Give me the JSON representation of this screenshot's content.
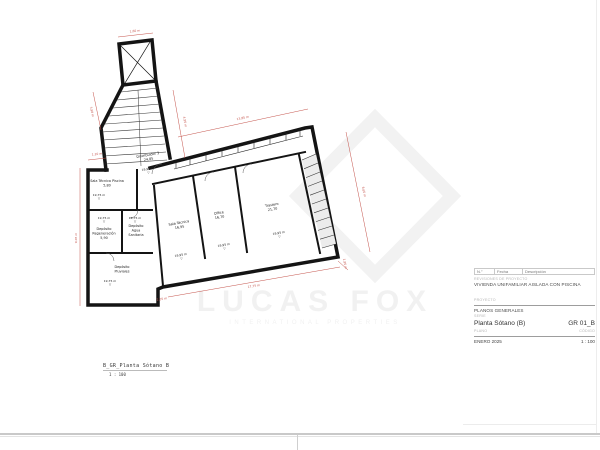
{
  "sheet": {
    "watermark": {
      "brand": "LUCAS FOX",
      "tagline": "INTERNATIONAL PROPERTIES"
    },
    "caption": {
      "title": "B_GR_Planta Sótano B",
      "scale": "1 : 100"
    },
    "titleblock": {
      "rev_col_no": "N.°",
      "rev_col_date": "Fecha",
      "rev_col_desc": "Descripción",
      "revisions_label": "REVISIONES DE PROYECTO",
      "project_name": "VIVIENDA UNIFAMILIAR AISLADA CON PISCINA",
      "project_label": "PROYECTO",
      "series_name": "PLANOS GENERALES",
      "series_label": "SERIE",
      "plan_name": "Planta Sótano (B)",
      "plan_code": "GR 01_B",
      "plan_label": "PLANO",
      "code_label": "CÓDIGO",
      "date": "ENERO 2025",
      "scale": "1 : 100"
    },
    "plan": {
      "rooms": [
        {
          "lines": [
            "Distribuidor 3",
            "24,85"
          ],
          "x": 148,
          "y": 156,
          "rot": -10
        },
        {
          "lines": [
            "Sala Técnica Piscina",
            "5,80"
          ],
          "x": 107,
          "y": 182,
          "rot": 0
        },
        {
          "lines": [
            "Depósito",
            "Regeneración",
            "5,90"
          ],
          "x": 104,
          "y": 230,
          "rot": 0
        },
        {
          "lines": [
            "Depósito",
            "Agua",
            "Sanitaria"
          ],
          "x": 136,
          "y": 227,
          "rot": 0
        },
        {
          "lines": [
            "Depósito",
            "Pluviales"
          ],
          "x": 122,
          "y": 268,
          "rot": 0
        },
        {
          "lines": [
            "Sala Técnica",
            "16,95"
          ],
          "x": 179,
          "y": 224,
          "rot": -10
        },
        {
          "lines": [
            "Office",
            "16,70"
          ],
          "x": 219,
          "y": 214,
          "rot": -10
        },
        {
          "lines": [
            "Trastero",
            "21,70"
          ],
          "x": 272,
          "y": 206,
          "rot": -10
        }
      ],
      "elevations": [
        {
          "value": "19,95 m",
          "x": 148,
          "y": 170,
          "rot": -10
        },
        {
          "value": "19,75 m",
          "x": 99,
          "y": 196,
          "rot": 0
        },
        {
          "value": "19,75 m",
          "x": 104,
          "y": 219,
          "rot": 0
        },
        {
          "value": "19,75 m",
          "x": 135,
          "y": 219,
          "rot": 0
        },
        {
          "value": "19,75 m",
          "x": 110,
          "y": 282,
          "rot": 0
        },
        {
          "value": "19,95 m",
          "x": 181,
          "y": 256,
          "rot": -10
        },
        {
          "value": "19,95 m",
          "x": 224,
          "y": 246,
          "rot": -10
        },
        {
          "value": "19,95 m",
          "x": 279,
          "y": 234,
          "rot": -10
        }
      ],
      "dims": [
        {
          "text": "1,60 m",
          "x": 135,
          "y": 32,
          "rot": -7
        },
        {
          "text": "3,90 m",
          "x": 91,
          "y": 112,
          "rot": 78
        },
        {
          "text": "4,95 m",
          "x": 184,
          "y": 122,
          "rot": 80
        },
        {
          "text": "13,85 m",
          "x": 243,
          "y": 119,
          "rot": -12
        },
        {
          "text": "8,65 m",
          "x": 363,
          "y": 192,
          "rot": 79
        },
        {
          "text": "17,75 m",
          "x": 254,
          "y": 287,
          "rot": -9
        },
        {
          "text": "9,05 m",
          "x": 77,
          "y": 238,
          "rot": -90
        },
        {
          "text": "1,10 m",
          "x": 97,
          "y": 155,
          "rot": -5
        },
        {
          "text": "1,95 m",
          "x": 344,
          "y": 264,
          "rot": 79
        },
        {
          "text": "2,05 m",
          "x": 162,
          "y": 300,
          "rot": -9
        }
      ]
    }
  }
}
